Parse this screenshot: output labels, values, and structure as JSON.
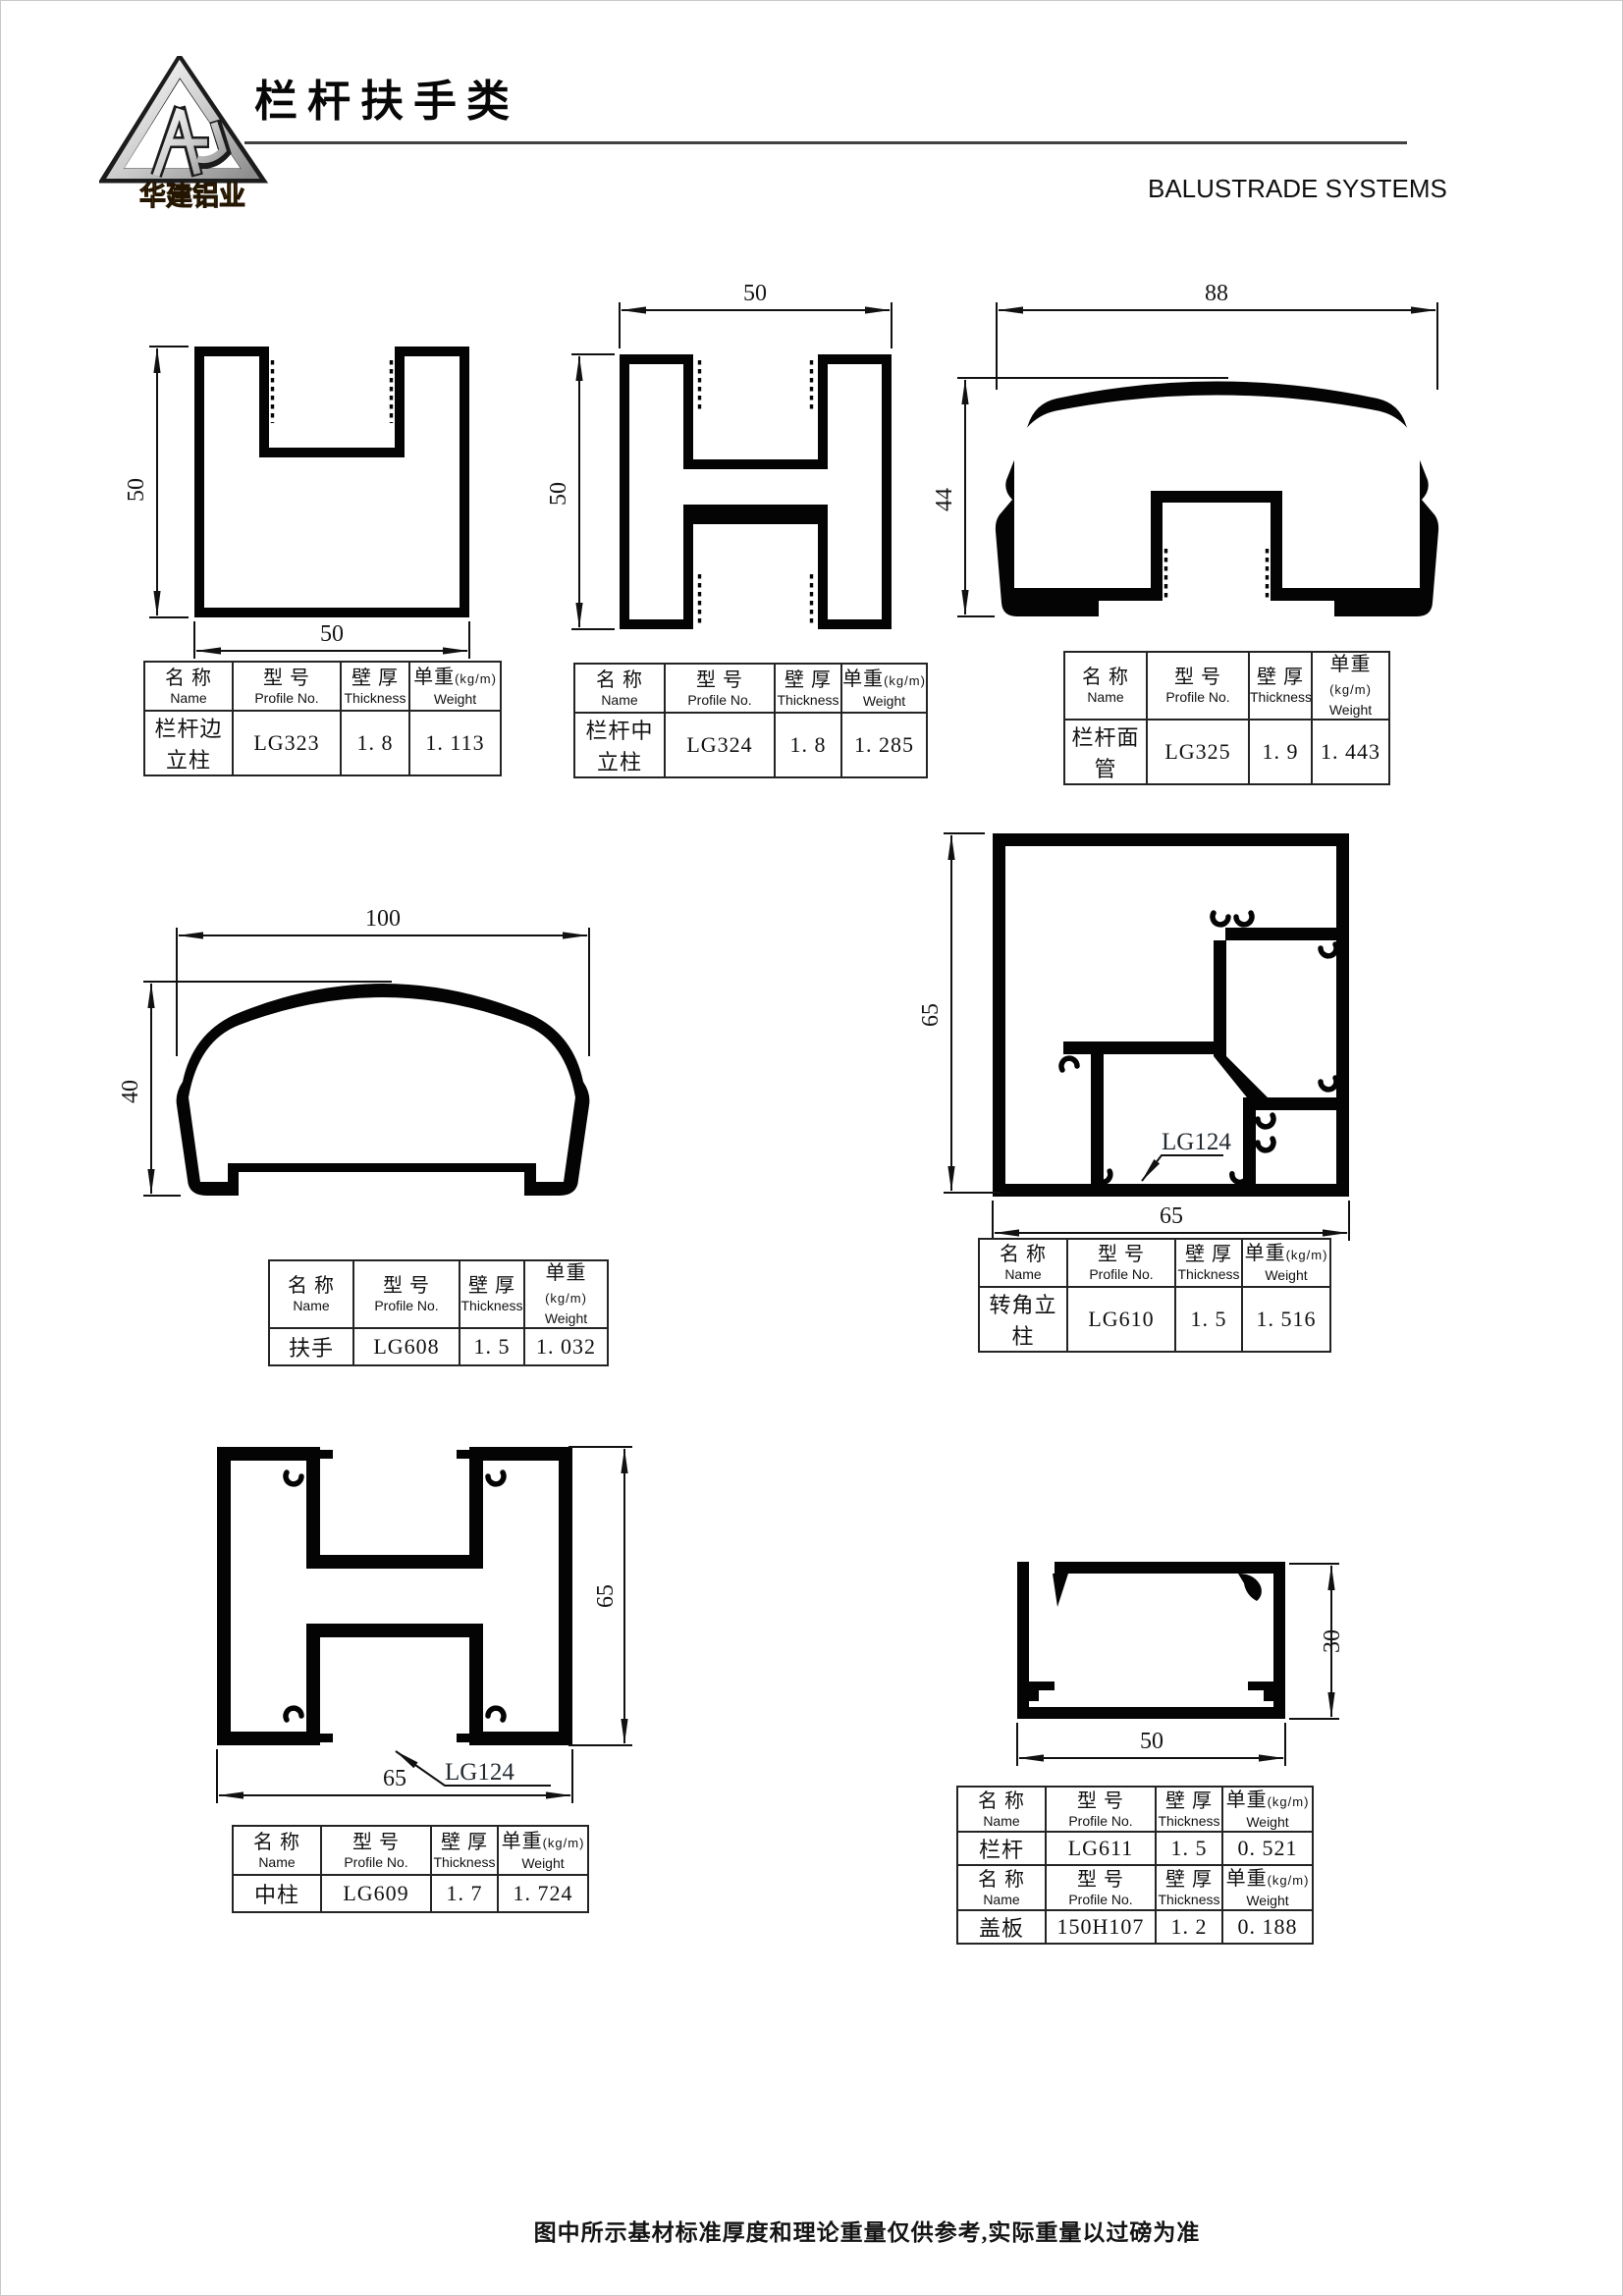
{
  "header": {
    "logo_text": "华建铝业",
    "title": "栏杆扶手类",
    "subtitle": "BALUSTRADE SYSTEMS"
  },
  "th": {
    "name_zh": "名 称",
    "name_en": "Name",
    "no_zh": "型 号",
    "no_en": "Profile No.",
    "thk_zh": "壁 厚",
    "thk_en": "Thickness",
    "wt_zh": "单重",
    "wt_unit": "(kg/m)",
    "wt_en": "Weight"
  },
  "profiles": {
    "lg323": {
      "name": "栏杆边立柱",
      "no": "LG323",
      "thickness": "1. 8",
      "weight": "1. 113",
      "dim_w": "50",
      "dim_h": "50"
    },
    "lg324": {
      "name": "栏杆中立柱",
      "no": "LG324",
      "thickness": "1. 8",
      "weight": "1. 285",
      "dim_w": "50",
      "dim_h": "50"
    },
    "lg325": {
      "name": "栏杆面管",
      "no": "LG325",
      "thickness": "1. 9",
      "weight": "1. 443",
      "dim_w": "88",
      "dim_h": "44"
    },
    "lg608": {
      "name": "扶手",
      "no": "LG608",
      "thickness": "1. 5",
      "weight": "1. 032",
      "dim_w": "100",
      "dim_h": "40"
    },
    "lg610": {
      "name": "转角立柱",
      "no": "LG610",
      "thickness": "1. 5",
      "weight": "1. 516",
      "dim_w": "65",
      "dim_h": "65",
      "callout": "LG124"
    },
    "lg609": {
      "name": "中柱",
      "no": "LG609",
      "thickness": "1. 7",
      "weight": "1. 724",
      "dim_w": "65",
      "dim_h": "65",
      "callout": "LG124"
    },
    "lg611": {
      "name": "栏杆",
      "no": "LG611",
      "thickness": "1. 5",
      "weight": "0. 521",
      "dim_w": "50",
      "dim_h": "30"
    },
    "cover": {
      "name": "盖板",
      "no": "150H107",
      "thickness": "1. 2",
      "weight": "0. 188"
    }
  },
  "footer": {
    "note": "图中所示基材标准厚度和理论重量仅供参考,实际重量以过磅为准"
  }
}
